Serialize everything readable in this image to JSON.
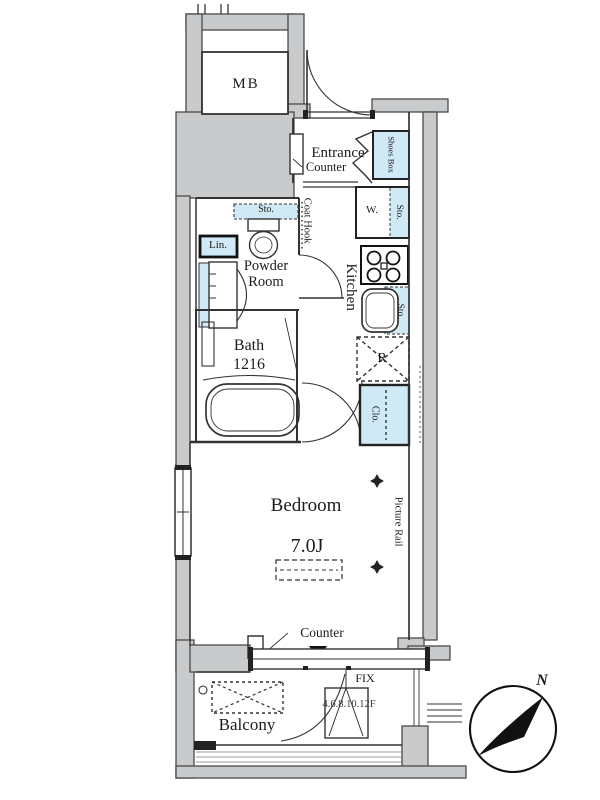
{
  "floorplan": {
    "mb": "MB",
    "entrance": {
      "label": "Entrance",
      "counter": "Counter"
    },
    "shoes_box": "Shoes Box",
    "coat_hook": "Coat Hook",
    "kitchen": "Kitchen",
    "washer": {
      "label": "W.",
      "storage": "Sto."
    },
    "sink_storage": "Sto.",
    "refrigerator": "R",
    "powder_room": {
      "label": "Powder Room",
      "storage": "Sto.",
      "linen": "Lin."
    },
    "bath": {
      "label": "Bath",
      "size": "1216"
    },
    "closet": "Clo.",
    "bedroom": {
      "label": "Bedroom",
      "size": "7.0J",
      "picture_rail": "Picture Rail",
      "counter": "Counter"
    },
    "balcony": "Balcony",
    "window": {
      "fix": "FIX",
      "floors": "4.6.8.10.12F"
    },
    "compass": {
      "north": "N"
    },
    "colors": {
      "wall": "#c8cacc",
      "fixture_blue": "#cfe9f5",
      "line": "#333333"
    }
  }
}
